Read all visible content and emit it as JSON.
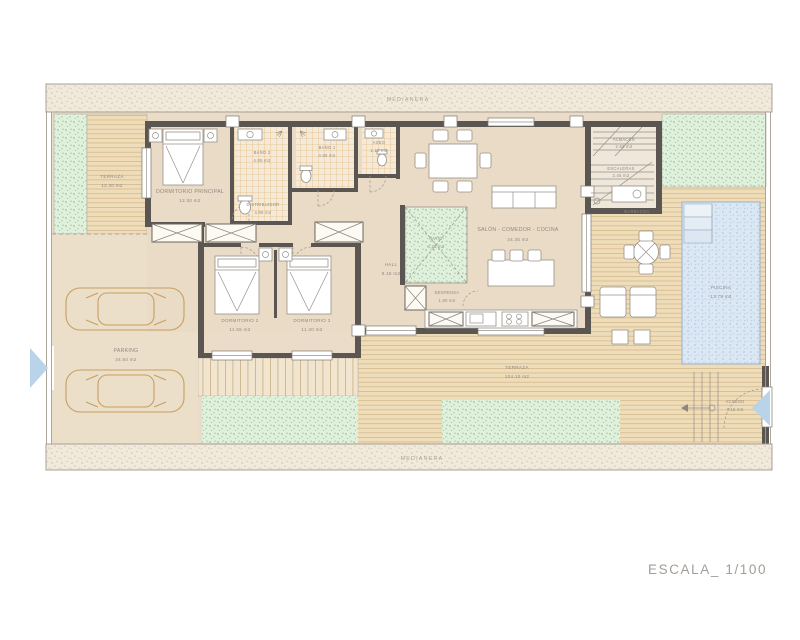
{
  "plan": {
    "boundary_top_label": "MEDIANERA",
    "boundary_bottom_label": "MEDIANERA",
    "scale_label": "ESCALA_ 1/100"
  },
  "rooms": {
    "terraza_top": {
      "name": "TERRAZA",
      "area": "12.30 m2"
    },
    "dormitorio_principal": {
      "name": "DORMITORIO PRINCIPAL",
      "area": "12.30 m2"
    },
    "bano_2": {
      "name": "BAÑO 2",
      "area": "4.85 m2"
    },
    "bano_1": {
      "name": "BAÑO 1",
      "area": "4.85 m2"
    },
    "aseo": {
      "name": "ASEO",
      "area": "2.10 m2"
    },
    "distribuidor": {
      "name": "DISTRIBUIDOR",
      "area": "4.95 m2"
    },
    "dormitorio_2": {
      "name": "DORMITORIO 2",
      "area": "11.55 m2"
    },
    "dormitorio_3": {
      "name": "DORMITORIO 3",
      "area": "11.30 m2"
    },
    "hall": {
      "name": "HALL",
      "area": "9.15 m2"
    },
    "patio": {
      "name": "PATIO",
      "area": "4.20 m2"
    },
    "salon": {
      "name": "SALÓN - COMEDOR - COCINA",
      "area": "34.35 m2"
    },
    "despensa": {
      "name": "DESPENSA",
      "area": "1.80 m2"
    },
    "parking": {
      "name": "PARKING",
      "area": "34.50 m2"
    },
    "almacen": {
      "name": "ALMACÉN",
      "area": "2.65 m2"
    },
    "escaleras": {
      "name": "ESCALERAS",
      "area": "2.45 m2"
    },
    "barbacoa": {
      "name": "BARBACOA",
      "area": ""
    },
    "piscina": {
      "name": "PISCINA",
      "area": "13.75 m2"
    },
    "terraza_main": {
      "name": "TERRAZA",
      "area": "104.10 m2"
    },
    "acceso": {
      "name": "ACCESO",
      "area": "7.15 m2"
    }
  },
  "colors": {
    "wall": "#5b5651",
    "floor": "#eadcc8",
    "deck": "#efddba",
    "deck_line": "#d3b98e",
    "grass": "#e0f0dd",
    "pool": "#dbe8f4",
    "tile_line": "#dfa95f",
    "label": "#8f8983",
    "entry_arrow": "#b9d3e8",
    "car_outline": "#c89f5e"
  }
}
